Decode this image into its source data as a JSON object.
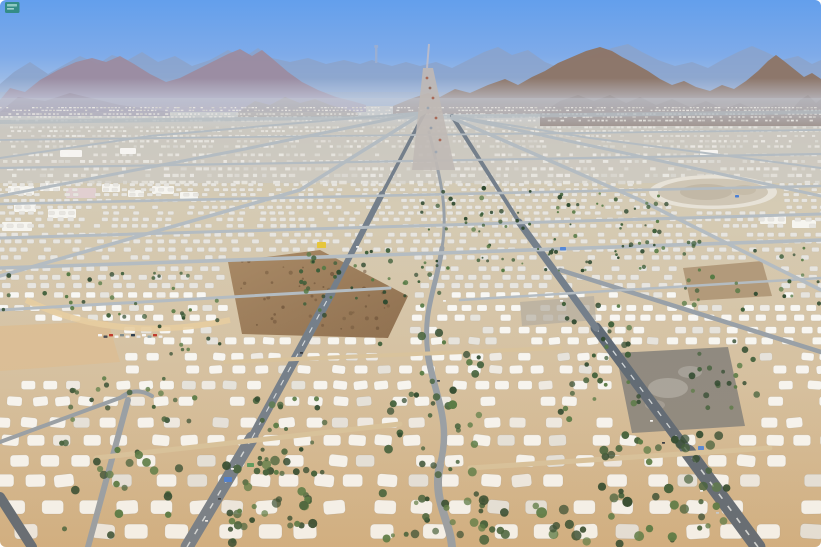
{
  "meta": {
    "description": "Aerial photograph of a vast desert tent city (Mina-style pilgrim camp) in a valley, with grid roads converging toward hazy mountains on the horizon"
  },
  "watermark": {
    "name": "news-agency-logo",
    "color": "#2f8a7d",
    "stripe1": "#9fd4c5",
    "stripe2": "#c8e8de"
  },
  "palette": {
    "sky_top": "#639fec",
    "sky_mid": "#7fabe9",
    "sky_low": "#a9c3e6",
    "sky_horizon": "#c7d5e8",
    "haze": "#cfdcf0",
    "mountain_far": "#8ba2c9",
    "mountain_left": "#9c8b9d",
    "mountain_left_foot": "#8a7684",
    "mountain_right": "#8d7465",
    "mountain_foothill": "#7d6355",
    "foothill_center": "#96816d",
    "tower": "#9fb0d0",
    "valley_top": "#c9c3b6",
    "valley_mid": "#d5cbb4",
    "valley_low": "#d6c1a0",
    "valley_bottom": "#d2b184",
    "city_tint": "#c6ced8",
    "tent_white": "#f8f7f3",
    "tent_dim": "#e6e4de",
    "tent_far": "#e7e5e0",
    "sand_lot": "#dbbf97",
    "rock_light": "#a98a66",
    "rock_dark": "#8f7050",
    "rock_speckle": "#6b5138",
    "patch_brown": "#ab9272",
    "patch_gray": "#b3aca0",
    "parking": "#8f8a81",
    "dust": "#d6d4cf",
    "oval_rim": "#e7e2d7",
    "oval_mid": "#cfc6b5",
    "oval_inner": "#b8ad99",
    "berm": "#e7cda1",
    "road_dark": "#5f6a76",
    "road_main": "#747f8b",
    "road_mid": "#98a0a8",
    "road_light": "#b4bcc2",
    "road_sand": "#d9c49e",
    "lane_dash": "#e8ecef",
    "highway": "#c0b9b5",
    "highway_pass": "#c5bfc6",
    "tree_dark": "#2f4a30",
    "tree_mid": "#3f5f3a",
    "tree_light": "#567a45"
  },
  "scene": {
    "speck_band": {
      "y0": 107,
      "y1": 182,
      "skip": 0.3
    },
    "tent_band": {
      "y0": 183,
      "y1": 545,
      "skip": 0.15
    },
    "avoid": [
      {
        "type": "ellipse",
        "cx": 713,
        "cy": 192,
        "rx": 68,
        "ry": 20
      },
      {
        "type": "rect",
        "x": 225,
        "y": 252,
        "w": 185,
        "h": 86
      },
      {
        "type": "rect",
        "x": 612,
        "y": 346,
        "w": 136,
        "h": 88
      },
      {
        "type": "rect",
        "x": 0,
        "y": 320,
        "w": 122,
        "h": 50
      },
      {
        "type": "rect",
        "x": 680,
        "y": 258,
        "w": 95,
        "h": 44
      }
    ],
    "warehouses": [
      {
        "x": 8,
        "y": 186,
        "w": 26,
        "h": 9
      },
      {
        "x": 40,
        "y": 183,
        "w": 20,
        "h": 8
      },
      {
        "x": 66,
        "y": 188,
        "w": 30,
        "h": 10,
        "c": "#e2cfd2"
      },
      {
        "x": 102,
        "y": 184,
        "w": 18,
        "h": 8
      },
      {
        "x": 14,
        "y": 204,
        "w": 22,
        "h": 8
      },
      {
        "x": 48,
        "y": 209,
        "w": 28,
        "h": 9
      },
      {
        "x": 128,
        "y": 190,
        "w": 16,
        "h": 7
      },
      {
        "x": 152,
        "y": 186,
        "w": 22,
        "h": 8
      },
      {
        "x": 180,
        "y": 192,
        "w": 18,
        "h": 7
      },
      {
        "x": 2,
        "y": 222,
        "w": 30,
        "h": 9
      },
      {
        "x": 760,
        "y": 215,
        "w": 26,
        "h": 9
      },
      {
        "x": 792,
        "y": 220,
        "w": 24,
        "h": 8
      },
      {
        "x": 700,
        "y": 150,
        "w": 18,
        "h": 6
      },
      {
        "x": 60,
        "y": 150,
        "w": 22,
        "h": 7
      },
      {
        "x": 120,
        "y": 148,
        "w": 16,
        "h": 6
      }
    ],
    "roads": [
      {
        "d": "M0,122 L821,112",
        "w": 4,
        "c": "road_light",
        "o": 0.7
      },
      {
        "d": "M187,547 L252,438",
        "w": 13,
        "c": "road_main",
        "dash": true
      },
      {
        "d": "M252,438 L331,293",
        "w": 9,
        "c": "road_main",
        "dash": true
      },
      {
        "d": "M331,293 L382,194",
        "w": 6,
        "c": "road_main"
      },
      {
        "d": "M382,194 L425,112",
        "w": 3.5,
        "c": "road_main"
      },
      {
        "d": "M758,547 L688,452",
        "w": 15,
        "c": "road_dark",
        "dash": true
      },
      {
        "d": "M688,452 L596,328",
        "w": 11,
        "c": "road_dark",
        "dash": true
      },
      {
        "d": "M596,328 L519,222",
        "w": 7,
        "c": "road_main"
      },
      {
        "d": "M519,222 L452,116",
        "w": 4,
        "c": "road_main"
      },
      {
        "d": "M429,132 C438,170 449,205 442,248",
        "w": 3,
        "c": "road_mid"
      },
      {
        "d": "M442,248 C436,290 422,310 428,355",
        "w": 5,
        "c": "road_mid"
      },
      {
        "d": "M428,355 C434,395 452,420 440,465",
        "w": 6.5,
        "c": "road_mid"
      },
      {
        "d": "M440,465 C432,500 450,520 452,547",
        "w": 8,
        "c": "road_mid"
      },
      {
        "d": "M0,497 L32,547",
        "w": 10,
        "c": "road_dark"
      },
      {
        "d": "M425,112 L240,150 L0,196",
        "w": 3,
        "c": "road_light"
      },
      {
        "d": "M425,112 L150,136 L0,158",
        "w": 2,
        "c": "road_light"
      },
      {
        "d": "M425,112 L300,190 L0,276",
        "w": 3.5,
        "c": "road_light"
      },
      {
        "d": "M452,116 L620,152 L821,196",
        "w": 3,
        "c": "road_light"
      },
      {
        "d": "M452,116 L590,138 L821,168",
        "w": 2,
        "c": "road_light"
      },
      {
        "d": "M452,118 L640,200 L821,290",
        "w": 3.5,
        "c": "road_light"
      },
      {
        "d": "M560,270 L821,352",
        "w": 4.5,
        "c": "road_mid"
      },
      {
        "d": "M0,140 L821,130",
        "w": 1.8,
        "c": "road_light"
      },
      {
        "d": "M0,168 L821,154",
        "w": 2.2,
        "c": "road_light"
      },
      {
        "d": "M0,204 L821,186",
        "w": 2.6,
        "c": "road_light"
      },
      {
        "d": "M0,238 L821,214",
        "w": 3,
        "c": "road_light"
      },
      {
        "d": "M0,268 L821,240",
        "w": 3.6,
        "c": "road_light"
      },
      {
        "d": "M0,310 L390,288",
        "w": 3,
        "c": "road_light"
      },
      {
        "d": "M460,300 L821,278",
        "w": 2.5,
        "c": "road_light"
      },
      {
        "d": "M120,398 Q135,386 152,396",
        "w": 4,
        "c": "road_mid"
      },
      {
        "d": "M0,442 L125,396",
        "w": 4,
        "c": "road_mid"
      },
      {
        "d": "M128,400 L88,547",
        "w": 6,
        "c": "road_mid"
      },
      {
        "d": "M96,458 L400,424",
        "w": 5,
        "c": "road_sand"
      },
      {
        "d": "M470,468 L770,448",
        "w": 5,
        "c": "road_sand"
      },
      {
        "d": "M225,362 L560,348",
        "w": 4,
        "c": "road_sand"
      }
    ],
    "tree_zones": [
      {
        "x": 420,
        "y": 186,
        "w": 250,
        "h": 85,
        "n": 90,
        "s0": 1,
        "s1": 2.4
      },
      {
        "x": 300,
        "y": 250,
        "w": 140,
        "h": 70,
        "n": 40,
        "s0": 1.3,
        "s1": 2.6
      },
      {
        "x": 560,
        "y": 300,
        "w": 80,
        "h": 120,
        "n": 30,
        "s0": 1.8,
        "s1": 3.2
      },
      {
        "x": 380,
        "y": 330,
        "w": 105,
        "h": 210,
        "n": 60,
        "s0": 2,
        "s1": 4.5
      },
      {
        "x": 600,
        "y": 430,
        "w": 130,
        "h": 110,
        "n": 40,
        "s0": 2.5,
        "s1": 5
      },
      {
        "x": 225,
        "y": 460,
        "w": 95,
        "h": 85,
        "n": 38,
        "s0": 2.5,
        "s1": 5
      },
      {
        "x": 255,
        "y": 395,
        "w": 70,
        "h": 80,
        "n": 24,
        "s0": 2,
        "s1": 3.6
      },
      {
        "x": 70,
        "y": 375,
        "w": 130,
        "h": 55,
        "n": 20,
        "s0": 1.8,
        "s1": 3
      },
      {
        "x": 0,
        "y": 272,
        "w": 190,
        "h": 45,
        "n": 24,
        "s0": 1.3,
        "s1": 2.4
      },
      {
        "x": 660,
        "y": 240,
        "w": 160,
        "h": 70,
        "n": 30,
        "s0": 1.4,
        "s1": 2.6
      },
      {
        "x": 690,
        "y": 330,
        "w": 70,
        "h": 80,
        "n": 20,
        "s0": 1.8,
        "s1": 3.4
      },
      {
        "x": 60,
        "y": 440,
        "w": 120,
        "h": 100,
        "n": 22,
        "s0": 2.5,
        "s1": 4.5
      },
      {
        "x": 480,
        "y": 500,
        "w": 200,
        "h": 45,
        "n": 20,
        "s0": 3,
        "s1": 5.5
      },
      {
        "x": 130,
        "y": 300,
        "w": 90,
        "h": 60,
        "n": 15,
        "s0": 1.5,
        "s1": 2.5
      }
    ],
    "cars": [
      {
        "x": 231,
        "y": 468,
        "c": "#f5f5f5"
      },
      {
        "x": 218,
        "y": 498,
        "c": "#3a4148"
      },
      {
        "x": 205,
        "y": 520,
        "c": "#f0f0f0"
      },
      {
        "x": 650,
        "y": 420,
        "c": "#f5f5f5"
      },
      {
        "x": 662,
        "y": 442,
        "c": "#2f3640"
      },
      {
        "x": 700,
        "y": 490,
        "c": "#f2f2f2"
      },
      {
        "x": 716,
        "y": 512,
        "c": "#c6cdd4"
      },
      {
        "x": 443,
        "y": 300,
        "c": "#f4f4f4"
      },
      {
        "x": 437,
        "y": 380,
        "c": "#444b52"
      },
      {
        "x": 560,
        "y": 300,
        "c": "#f0f0f0"
      },
      {
        "x": 356,
        "y": 246,
        "c": "#f2f2f2"
      },
      {
        "x": 300,
        "y": 352,
        "c": "#32383f"
      }
    ],
    "parked_car_colors": [
      "#f6f6f6",
      "#454b52",
      "#c0392b",
      "#f6f6f6",
      "#7f8c8d",
      "#f6f6f6",
      "#2c3e50",
      "#e8e8e8",
      "#f6f6f6",
      "#95a5a6",
      "#c0392b",
      "#f0f0f0"
    ],
    "structures": [
      {
        "x": 224,
        "y": 477,
        "w": 8,
        "h": 5,
        "c": "#4a7fd4"
      },
      {
        "x": 247,
        "y": 463,
        "w": 7,
        "h": 4,
        "c": "#5a9a5f"
      },
      {
        "x": 698,
        "y": 446,
        "w": 6,
        "h": 4,
        "c": "#5588d8"
      },
      {
        "x": 317,
        "y": 242,
        "w": 9,
        "h": 6,
        "c": "#e6c63c"
      },
      {
        "x": 735,
        "y": 195,
        "w": 4,
        "h": 2.5,
        "c": "#4a7fd4"
      },
      {
        "x": 560,
        "y": 247,
        "w": 6,
        "h": 3.5,
        "c": "#5588d8"
      }
    ],
    "highway_speckles": [
      [
        427,
        78,
        "#a55c48"
      ],
      [
        430,
        88,
        "#8a5a4a"
      ],
      [
        433,
        98,
        "#a55c48"
      ],
      [
        428,
        108,
        "#95a2b0"
      ],
      [
        436,
        118,
        "#a55c48"
      ],
      [
        431,
        128,
        "#8f9aa8"
      ],
      [
        440,
        140,
        "#a55c48"
      ],
      [
        436,
        152,
        "#9aa5b2"
      ]
    ]
  }
}
